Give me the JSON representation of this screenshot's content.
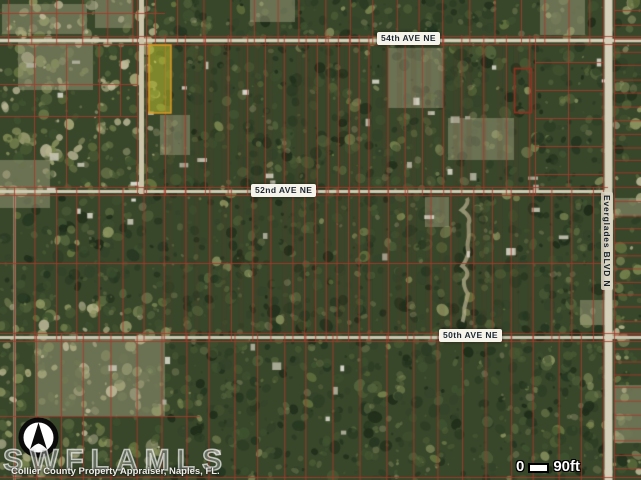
{
  "map": {
    "labels": {
      "ave54": "54th AVE NE",
      "ave52": "52nd AVE NE",
      "ave50": "50th AVE NE",
      "blvd": "Everglades BLVD N"
    },
    "scale": {
      "zero": "0",
      "max": "90ft"
    },
    "watermark": "SWFLAMLS",
    "attribution": "Collier County Property Appraiser, Naples, FL.",
    "icons": {
      "compass": "north-arrow-compass"
    },
    "colors": {
      "parcel_line": "#a93a2c",
      "parcel_line_dark": "#8e3222",
      "highlight_fill": "#b9be2d",
      "highlight_border": "#dd9a22",
      "road": "#d3cdb6",
      "label_bg": "#f6f3ea",
      "label_text": "#1c2733",
      "scale_text": "#ffffff"
    }
  }
}
